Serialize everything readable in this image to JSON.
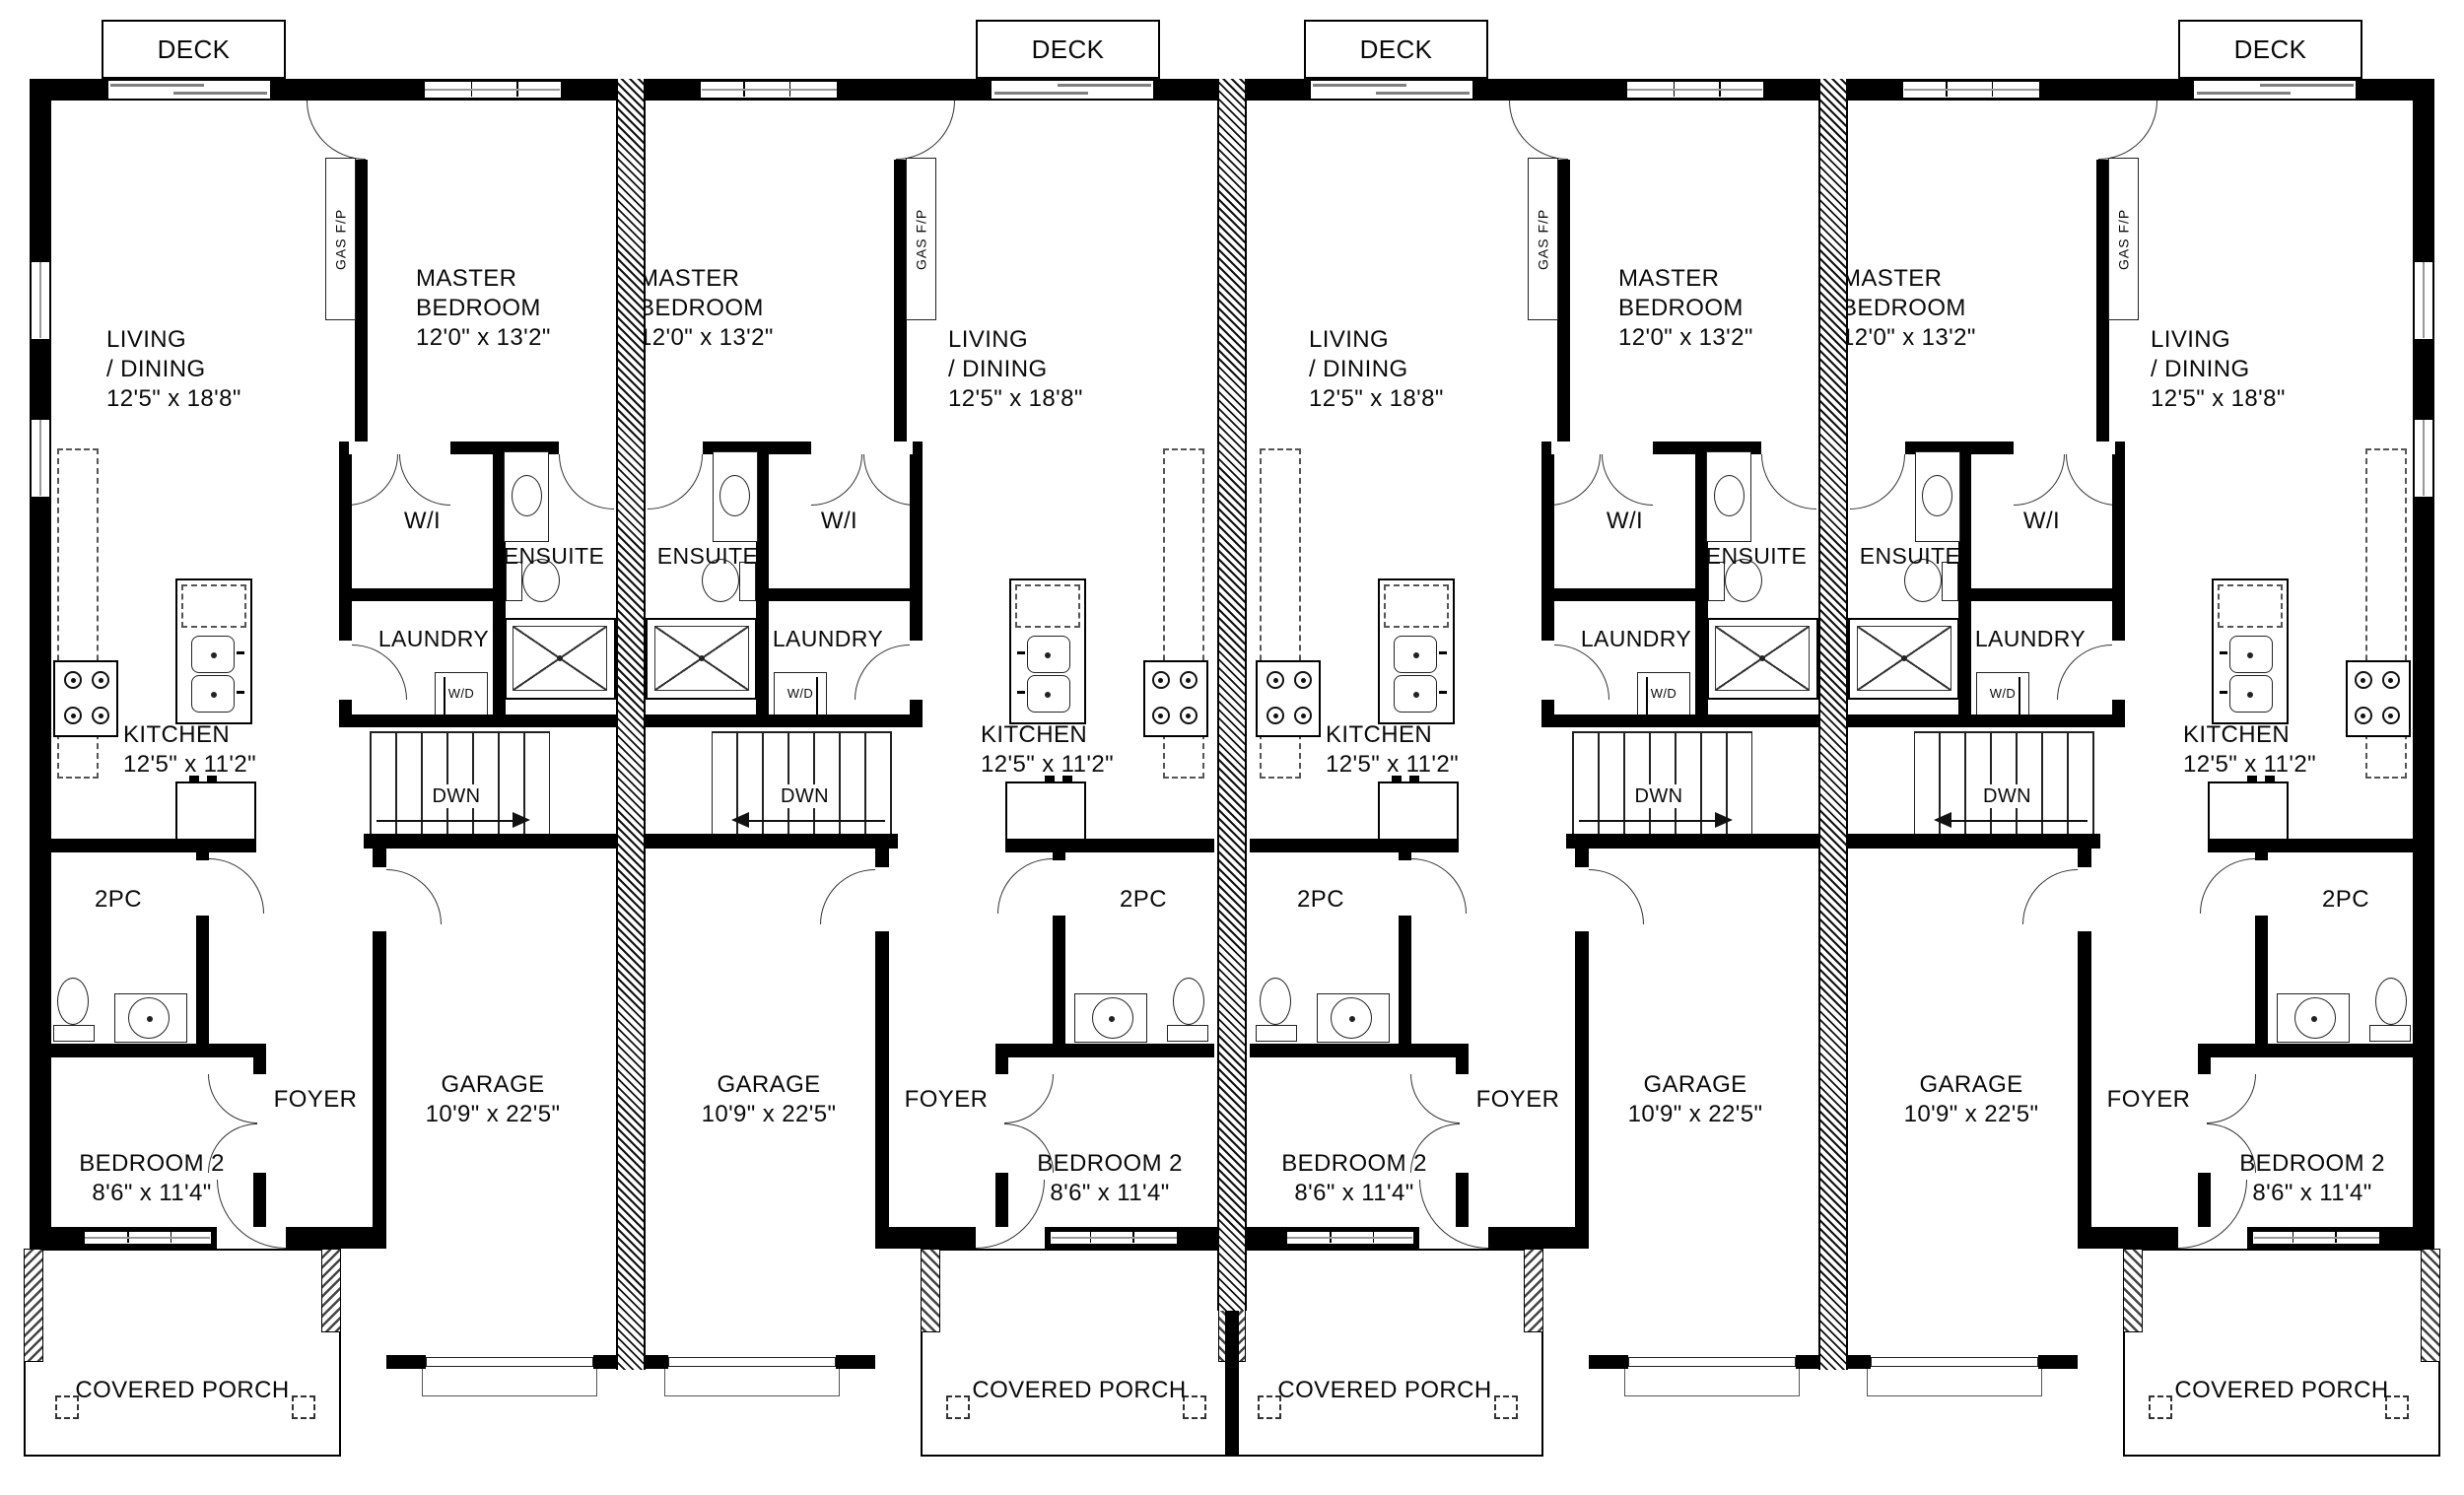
{
  "plan": {
    "type": "fourplex main floor plan",
    "colors": {
      "wall": "#000000",
      "background": "#ffffff",
      "fixture_line": "#222222",
      "door_line": "#333333",
      "window_line": "#808080"
    },
    "labels": {
      "deck": "DECK",
      "living": [
        "LIVING",
        "/ DINING",
        "12'5\" x 18'8\""
      ],
      "master": [
        "MASTER",
        "BEDROOM",
        "12'0\" x 13'2\""
      ],
      "gas_fp": "GAS F/P",
      "wi": "W/I",
      "ensuite": "ENSUITE",
      "laundry": "LAUNDRY",
      "wd": "W/D",
      "kitchen": [
        "KITCHEN",
        "12'5\" x 11'2\""
      ],
      "dwn": "DWN",
      "two_pc": "2PC",
      "foyer": "FOYER",
      "garage": [
        "GARAGE",
        "10'9\" x 22'5\""
      ],
      "bedroom2": [
        "BEDROOM 2",
        "8'6\" x 11'4\""
      ],
      "porch": "COVERED PORCH"
    },
    "units": [
      {
        "position": 1,
        "mirrored": false
      },
      {
        "position": 2,
        "mirrored": true
      },
      {
        "position": 3,
        "mirrored": false
      },
      {
        "position": 4,
        "mirrored": true
      }
    ]
  }
}
